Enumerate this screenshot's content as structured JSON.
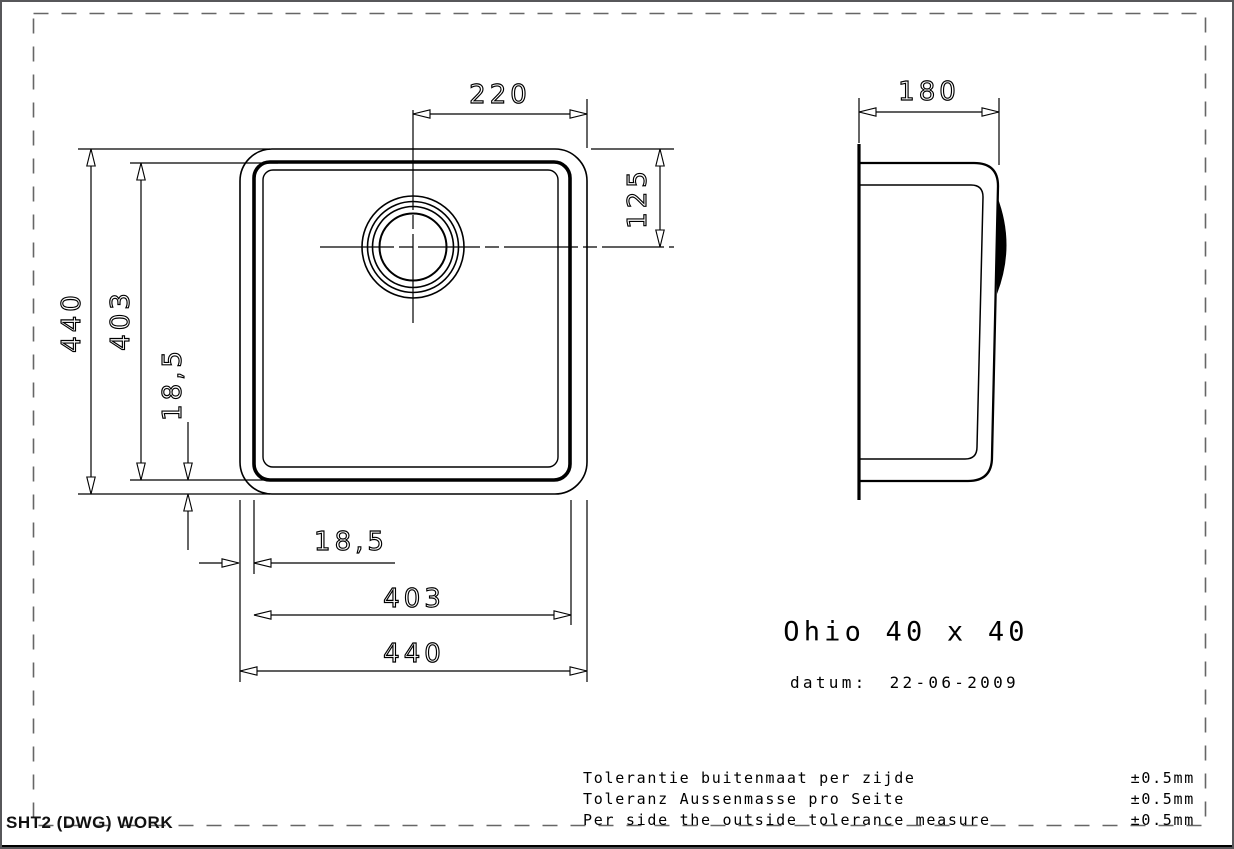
{
  "drawing": {
    "product": "Ohio 40 x 40",
    "date_label": "datum:",
    "date": "22-06-2009",
    "sheet_label": "SHT2 (DWG) WORK"
  },
  "dimensions": {
    "drain_offset_x": "220",
    "drain_offset_y": "125",
    "outer_size_vertical": "440",
    "bowl_size_vertical": "403",
    "rim_vertical": "18,5",
    "rim_horizontal": "18,5",
    "bowl_size_horizontal": "403",
    "outer_size_horizontal": "440",
    "depth": "180"
  },
  "tolerances": {
    "rows": [
      {
        "label": "Tolerantie buitenmaat per zijde",
        "value": "±0.5mm"
      },
      {
        "label": "Toleranz Aussenmasse pro Seite",
        "value": "±0.5mm"
      },
      {
        "label": "Per side the outside tolerance measure",
        "value": "±0.5mm"
      }
    ]
  },
  "colors": {
    "line": "#000000",
    "frame_dash": "#666666",
    "page_border": "#57575a",
    "background": "#ffffff"
  }
}
